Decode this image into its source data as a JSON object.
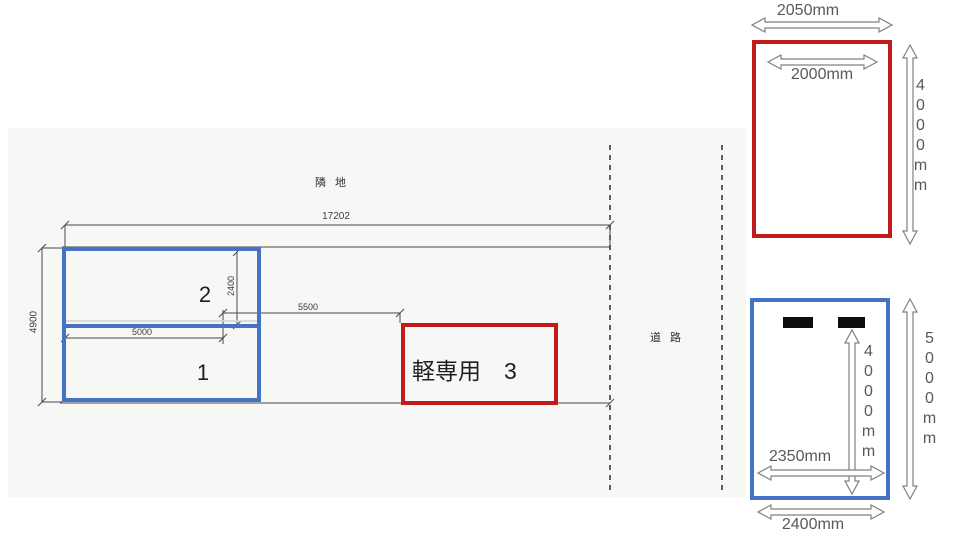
{
  "site_plan": {
    "neighbor_label": "隣 地",
    "road_label": "道 路",
    "overall_width": "17202",
    "overall_depth": "4900",
    "space1_width": "5000",
    "space2_depth": "2400",
    "gap_width": "5500",
    "space2_label": "2",
    "space1_label": "1",
    "space3_label": "軽専用　3"
  },
  "red_detail": {
    "outer_width": "2050mm",
    "inner_width": "2000mm",
    "depth": "4000mm"
  },
  "blue_detail": {
    "stopper_depth": "4000mm",
    "outer_depth": "5000mm",
    "inner_width": "2350mm",
    "outer_width": "2400mm"
  },
  "colors": {
    "box_blue": "#4472c4",
    "box_red": "#c21b1b",
    "dimension_text": "#595959",
    "scan_line": "#4a4a4a"
  }
}
